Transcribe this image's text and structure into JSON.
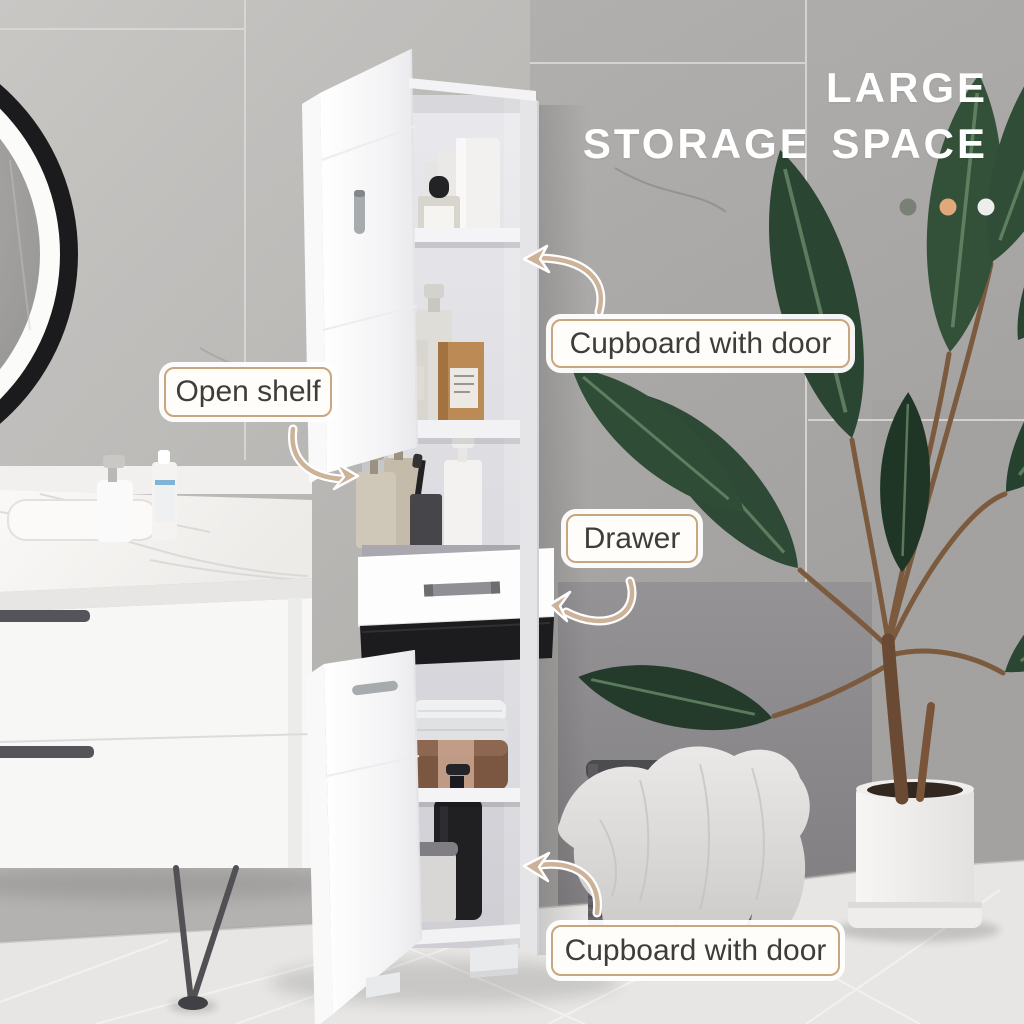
{
  "image_type": "product-lifestyle-photo",
  "headline": {
    "line1": "LARGE",
    "line2": "STORAGE SPACE"
  },
  "color_dots": [
    {
      "name": "gray",
      "hex": "#798177"
    },
    {
      "name": "tan",
      "hex": "#e1a97b"
    },
    {
      "name": "white",
      "hex": "#ededed"
    }
  ],
  "callouts": {
    "cupboard_top": "Cupboard with door",
    "open_shelf": "Open shelf",
    "drawer": "Drawer",
    "cupboard_bottom": "Cupboard with door"
  },
  "scene": {
    "objects": [
      "tall white bathroom storage cabinet with open doors",
      "round black-framed mirror",
      "white marble-top vanity with hairpin leg",
      "toiletries and towels on shelves",
      "potted banana-leaf plant in white pot",
      "woven laundry basket with draped towel"
    ]
  },
  "style": {
    "callout_border_color": "#c8a67f",
    "callout_text_color": "#3e3d3b",
    "arrow_color": "#ccb298",
    "headline_color": "#ffffff"
  }
}
